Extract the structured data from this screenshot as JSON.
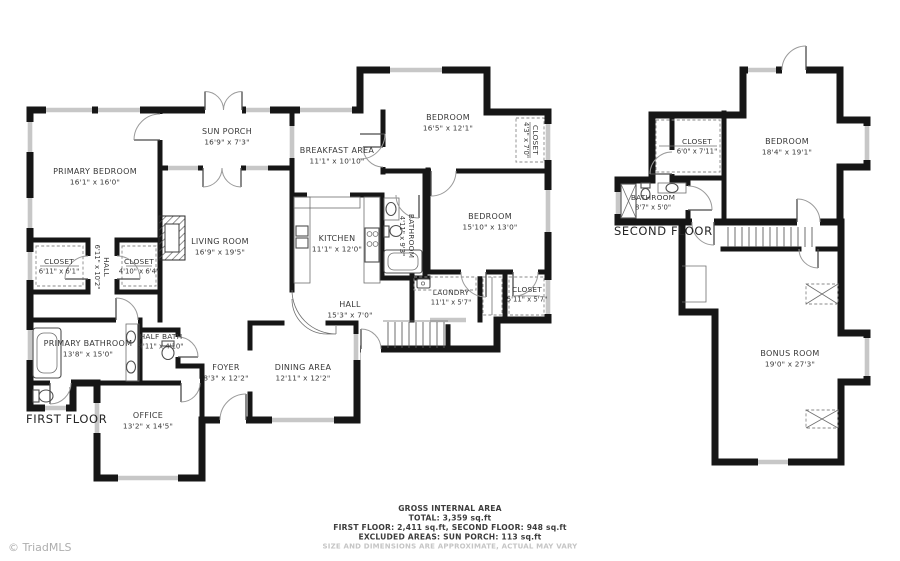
{
  "first_floor": {
    "label": "FIRST FLOOR",
    "rooms": {
      "primary_bedroom": {
        "name": "PRIMARY BEDROOM",
        "dims": "16'1\" x 16'0\""
      },
      "sun_porch": {
        "name": "SUN PORCH",
        "dims": "16'9\" x 7'3\""
      },
      "breakfast_area": {
        "name": "BREAKFAST AREA",
        "dims": "11'1\" x 10'10\""
      },
      "bedroom_top": {
        "name": "BEDROOM",
        "dims": "16'5\" x 12'1\""
      },
      "closet_top": {
        "name": "CLOSET",
        "dims": "4'3\" x 7'0\""
      },
      "living_room": {
        "name": "LIVING ROOM",
        "dims": "16'9\" x 19'5\""
      },
      "kitchen": {
        "name": "KITCHEN",
        "dims": "11'1\" x 12'0\""
      },
      "bathroom": {
        "name": "BATHROOM",
        "dims": "4'11\" x 9'3\""
      },
      "bedroom_right": {
        "name": "BEDROOM",
        "dims": "15'10\" x 13'0\""
      },
      "closet_left": {
        "name": "CLOSET",
        "dims": "6'11\" x 6'1\""
      },
      "hall_closets": {
        "name": "HALL",
        "dims": "6'11\" x 10'2\""
      },
      "closet_mid": {
        "name": "CLOSET",
        "dims": "4'10\" x 6'4\""
      },
      "primary_bathroom": {
        "name": "PRIMARY BATHROOM",
        "dims": "13'8\" x 15'0\""
      },
      "half_bath": {
        "name": "HALF BATH",
        "dims": "4'11\" x 4'10\""
      },
      "hall_main": {
        "name": "HALL",
        "dims": "15'3\" x 7'0\""
      },
      "laundry": {
        "name": "LAUNDRY",
        "dims": "11'1\" x 5'7\""
      },
      "closet_laundry": {
        "name": "CLOSET",
        "dims": "5'11\" x 5'7\""
      },
      "foyer": {
        "name": "FOYER",
        "dims": "8'3\" x 12'2\""
      },
      "dining_area": {
        "name": "DINING AREA",
        "dims": "12'11\" x 12'2\""
      },
      "office": {
        "name": "OFFICE",
        "dims": "13'2\" x 14'5\""
      }
    }
  },
  "second_floor": {
    "label": "SECOND FLOOR",
    "rooms": {
      "closet": {
        "name": "CLOSET",
        "dims": "6'0\" x 7'11\""
      },
      "bedroom": {
        "name": "BEDROOM",
        "dims": "18'4\" x 19'1\""
      },
      "bathroom": {
        "name": "BATHROOM",
        "dims": "8'7\" x 5'0\""
      },
      "bonus_room": {
        "name": "BONUS ROOM",
        "dims": "19'0\" x 27'3\""
      }
    }
  },
  "summary": {
    "title": "GROSS INTERNAL AREA",
    "total": "TOTAL: 3,359 sq.ft",
    "floors": "FIRST FLOOR: 2,411 sq.ft, SECOND FLOOR: 948 sq.ft",
    "excluded": "EXCLUDED AREAS: SUN PORCH: 113 sq.ft",
    "disclaimer": "SIZE AND DIMENSIONS ARE APPROXIMATE, ACTUAL MAY VARY"
  },
  "watermark": "© TriadMLS",
  "colors": {
    "wall": "#161616",
    "text": "#383838",
    "window": "#c7c7c7",
    "muted": "#c5c5c5"
  }
}
